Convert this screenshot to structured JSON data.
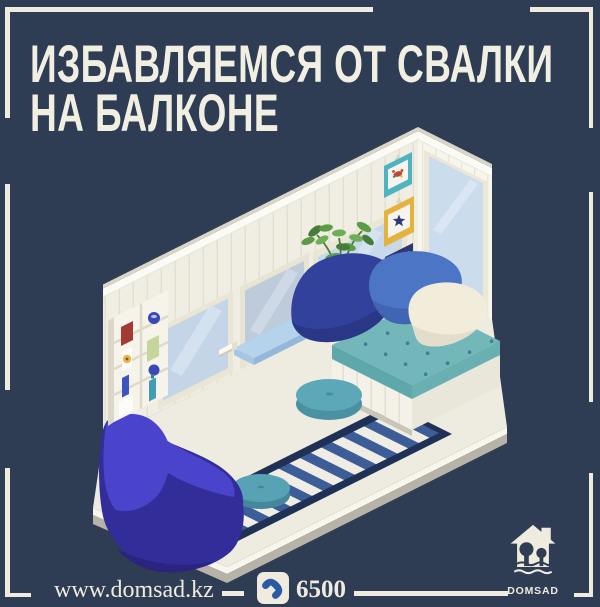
{
  "title": {
    "line1": "ИЗБАВЛЯЕМСЯ ОТ СВАЛКИ",
    "line2": "НА БАЛКОНЕ"
  },
  "footer": {
    "website": "www.domsad.kz",
    "phone": "6500",
    "phone_icon": "phone-handset-icon"
  },
  "logo": {
    "label": "DOMSAD",
    "icon": "house-with-trees-icon"
  },
  "palette": {
    "background": "#2e3c54",
    "cream": "#efecdf",
    "wall_white": "#f0eee3",
    "glass_blue": "#c7d8ea",
    "sill_blue": "#b6d3ec",
    "rug_navy": "#203156",
    "rug_blue": "#3d5d99",
    "mattress_teal": "#74b7ba",
    "pouf_teal": "#5ca8b9",
    "pillow_navy": "#32419b",
    "pillow_blue": "#4c75c5",
    "pillow_cream": "#f1edda",
    "bean_bag_bright": "#4a44cd",
    "bean_bag_dark": "#332d99",
    "phone_blue": "#2b5ba4"
  },
  "illustration": {
    "name": "isometric-balcony-scene",
    "items": [
      "paneled-walls",
      "glass-door",
      "windows",
      "window-sill",
      "wall-shelf",
      "picture-frames",
      "potted-plant",
      "yellow-mug",
      "daybed-with-cushions",
      "round-poufs",
      "striped-rug",
      "bean-bag-chair",
      "floor-platform"
    ]
  }
}
